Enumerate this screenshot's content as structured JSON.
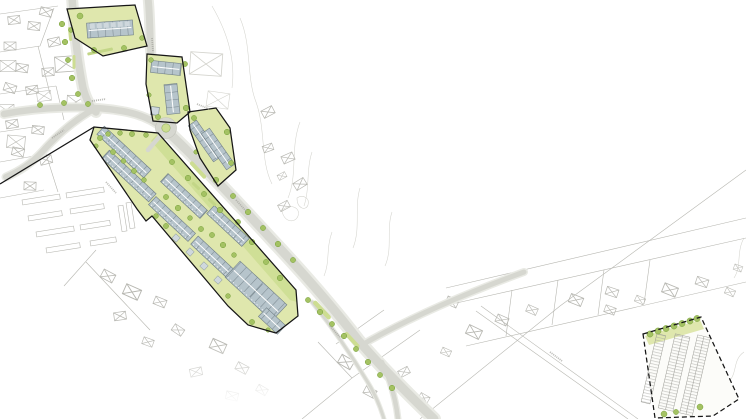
{
  "map": {
    "alt": "Urban development site plan: proposed housing slabs along a diagonal main street with a roundabout, four solid-outlined planning areas, a dashed-outlined parking lot at lower right, street trees and existing cadastral buildings drawn as faint outlines with crosses",
    "road_labels_legible": false,
    "colors": {
      "background": "#ffffff",
      "cadastral_line": "#b7b7b1",
      "cadastral_soft": "#d4d4ce",
      "road_casing": "#e9eae4",
      "road_fill": "#d6d7d0",
      "road_edge": "#c2c3bb",
      "green_ground": "#dfe7ad",
      "green_band": "#cddd92",
      "hedge": "#c3d687",
      "tree_fill": "#a4c263",
      "tree_edge": "#76a03a",
      "building_fill": "#b6c4cb",
      "building_edge": "#6f7e85",
      "building_light": "#cfd8dd",
      "building_ridge": "#ffffff",
      "boundary": "#161616",
      "parking_ground": "#fcfcf9",
      "parking_line": "#9b9b95",
      "microtext": "#a4a49e"
    },
    "planning_areas": [
      {
        "id": "north-block",
        "outline": "solid",
        "new_buildings": 1
      },
      {
        "id": "east-block",
        "outline": "solid",
        "new_buildings": 3
      },
      {
        "id": "wedge-block",
        "outline": "solid",
        "new_buildings": 2
      },
      {
        "id": "main-strip",
        "outline": "solid",
        "new_buildings": 8,
        "pavilions": 4
      },
      {
        "id": "parking-lot",
        "outline": "dashed",
        "parking_rows": 3
      }
    ],
    "road_features": [
      "roundabout",
      "main-street",
      "side-streets",
      "street-trees",
      "green-medians"
    ]
  }
}
